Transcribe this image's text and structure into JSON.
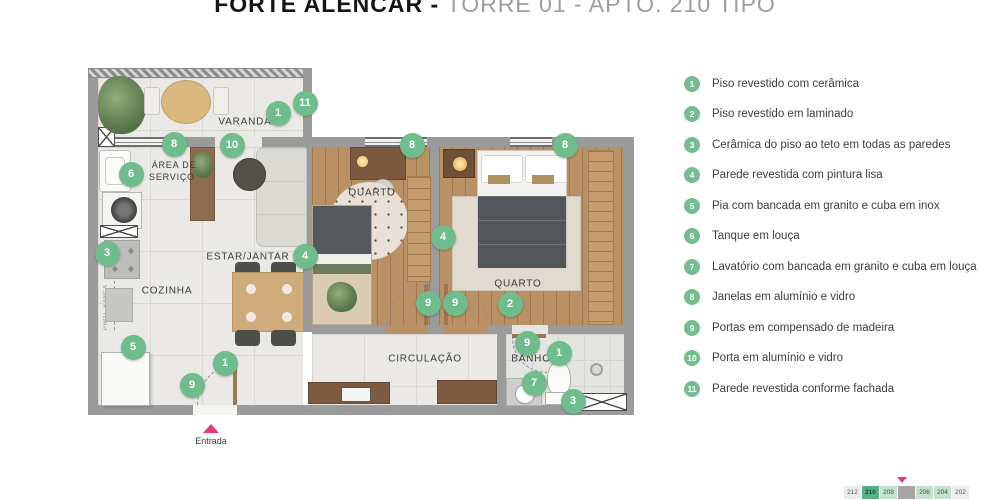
{
  "title": {
    "project": "FORTE ALENCAR - ",
    "unit": "TORRE 01 - APTO. 210 TIPO"
  },
  "plan": {
    "room_labels": {
      "varanda": "VARANDA",
      "area_servico_l1": "ÁREA DE",
      "area_servico_l2": "SERVIÇO",
      "cozinha": "COZINHA",
      "estar": "ESTAR/JANTAR",
      "quarto1": "QUARTO",
      "quarto2": "QUARTO",
      "circulacao": "CIRCULAÇÃO",
      "banho": "BANHO",
      "proj_sanca": "PROJ. SANCA",
      "proj_exaustao": "PROJ. EXAUSTÃO BANHO"
    },
    "entrance_label": "Entrada",
    "markers": [
      {
        "n": "11",
        "x": 220,
        "y": 41
      },
      {
        "n": "1",
        "x": 193,
        "y": 51
      },
      {
        "n": "10",
        "x": 147,
        "y": 83
      },
      {
        "n": "8",
        "x": 89,
        "y": 82
      },
      {
        "n": "8",
        "x": 327,
        "y": 83
      },
      {
        "n": "8",
        "x": 480,
        "y": 83
      },
      {
        "n": "6",
        "x": 46,
        "y": 112
      },
      {
        "n": "3",
        "x": 22,
        "y": 191
      },
      {
        "n": "4",
        "x": 220,
        "y": 194
      },
      {
        "n": "4",
        "x": 358,
        "y": 175
      },
      {
        "n": "5",
        "x": 48,
        "y": 285
      },
      {
        "n": "1",
        "x": 140,
        "y": 301
      },
      {
        "n": "9",
        "x": 107,
        "y": 323
      },
      {
        "n": "9",
        "x": 343,
        "y": 241
      },
      {
        "n": "9",
        "x": 370,
        "y": 241
      },
      {
        "n": "2",
        "x": 425,
        "y": 242
      },
      {
        "n": "9",
        "x": 442,
        "y": 281
      },
      {
        "n": "1",
        "x": 474,
        "y": 291
      },
      {
        "n": "7",
        "x": 449,
        "y": 321
      },
      {
        "n": "3",
        "x": 488,
        "y": 339
      }
    ]
  },
  "legend": {
    "items": [
      {
        "num": "1",
        "text": "Piso revestido com cerâmica"
      },
      {
        "num": "2",
        "text": "Piso revestido em laminado"
      },
      {
        "num": "3",
        "text": "Cerâmica do piso ao teto em todas as paredes"
      },
      {
        "num": "4",
        "text": "Parede revestida com pintura lisa"
      },
      {
        "num": "5",
        "text": "Pia com bancada em granito e cuba em inox"
      },
      {
        "num": "6",
        "text": "Tanque em louça"
      },
      {
        "num": "7",
        "text": "Lavatório com bancada em granito e cuba em louça"
      },
      {
        "num": "8",
        "text": "Janelas em alumínio e vidro"
      },
      {
        "num": "9",
        "text": "Portas em compensado de madeira"
      },
      {
        "num": "10",
        "text": "Porta em alumínio e vidro"
      },
      {
        "num": "11",
        "text": "Parede revestida conforme fachada"
      }
    ]
  },
  "unit_strip": {
    "units": [
      {
        "label": "212",
        "state": "muted"
      },
      {
        "label": "210",
        "state": "selected"
      },
      {
        "label": "208",
        "state": "light"
      },
      {
        "label": "",
        "state": "blank"
      },
      {
        "label": "206",
        "state": "light"
      },
      {
        "label": "204",
        "state": "light"
      },
      {
        "label": "202",
        "state": "muted"
      }
    ]
  },
  "colors": {
    "marker_green": "#6fbc8d",
    "accent_pink": "#e8396f",
    "wall_gray": "#9b9b9b",
    "selected_unit_green": "#57b183"
  }
}
